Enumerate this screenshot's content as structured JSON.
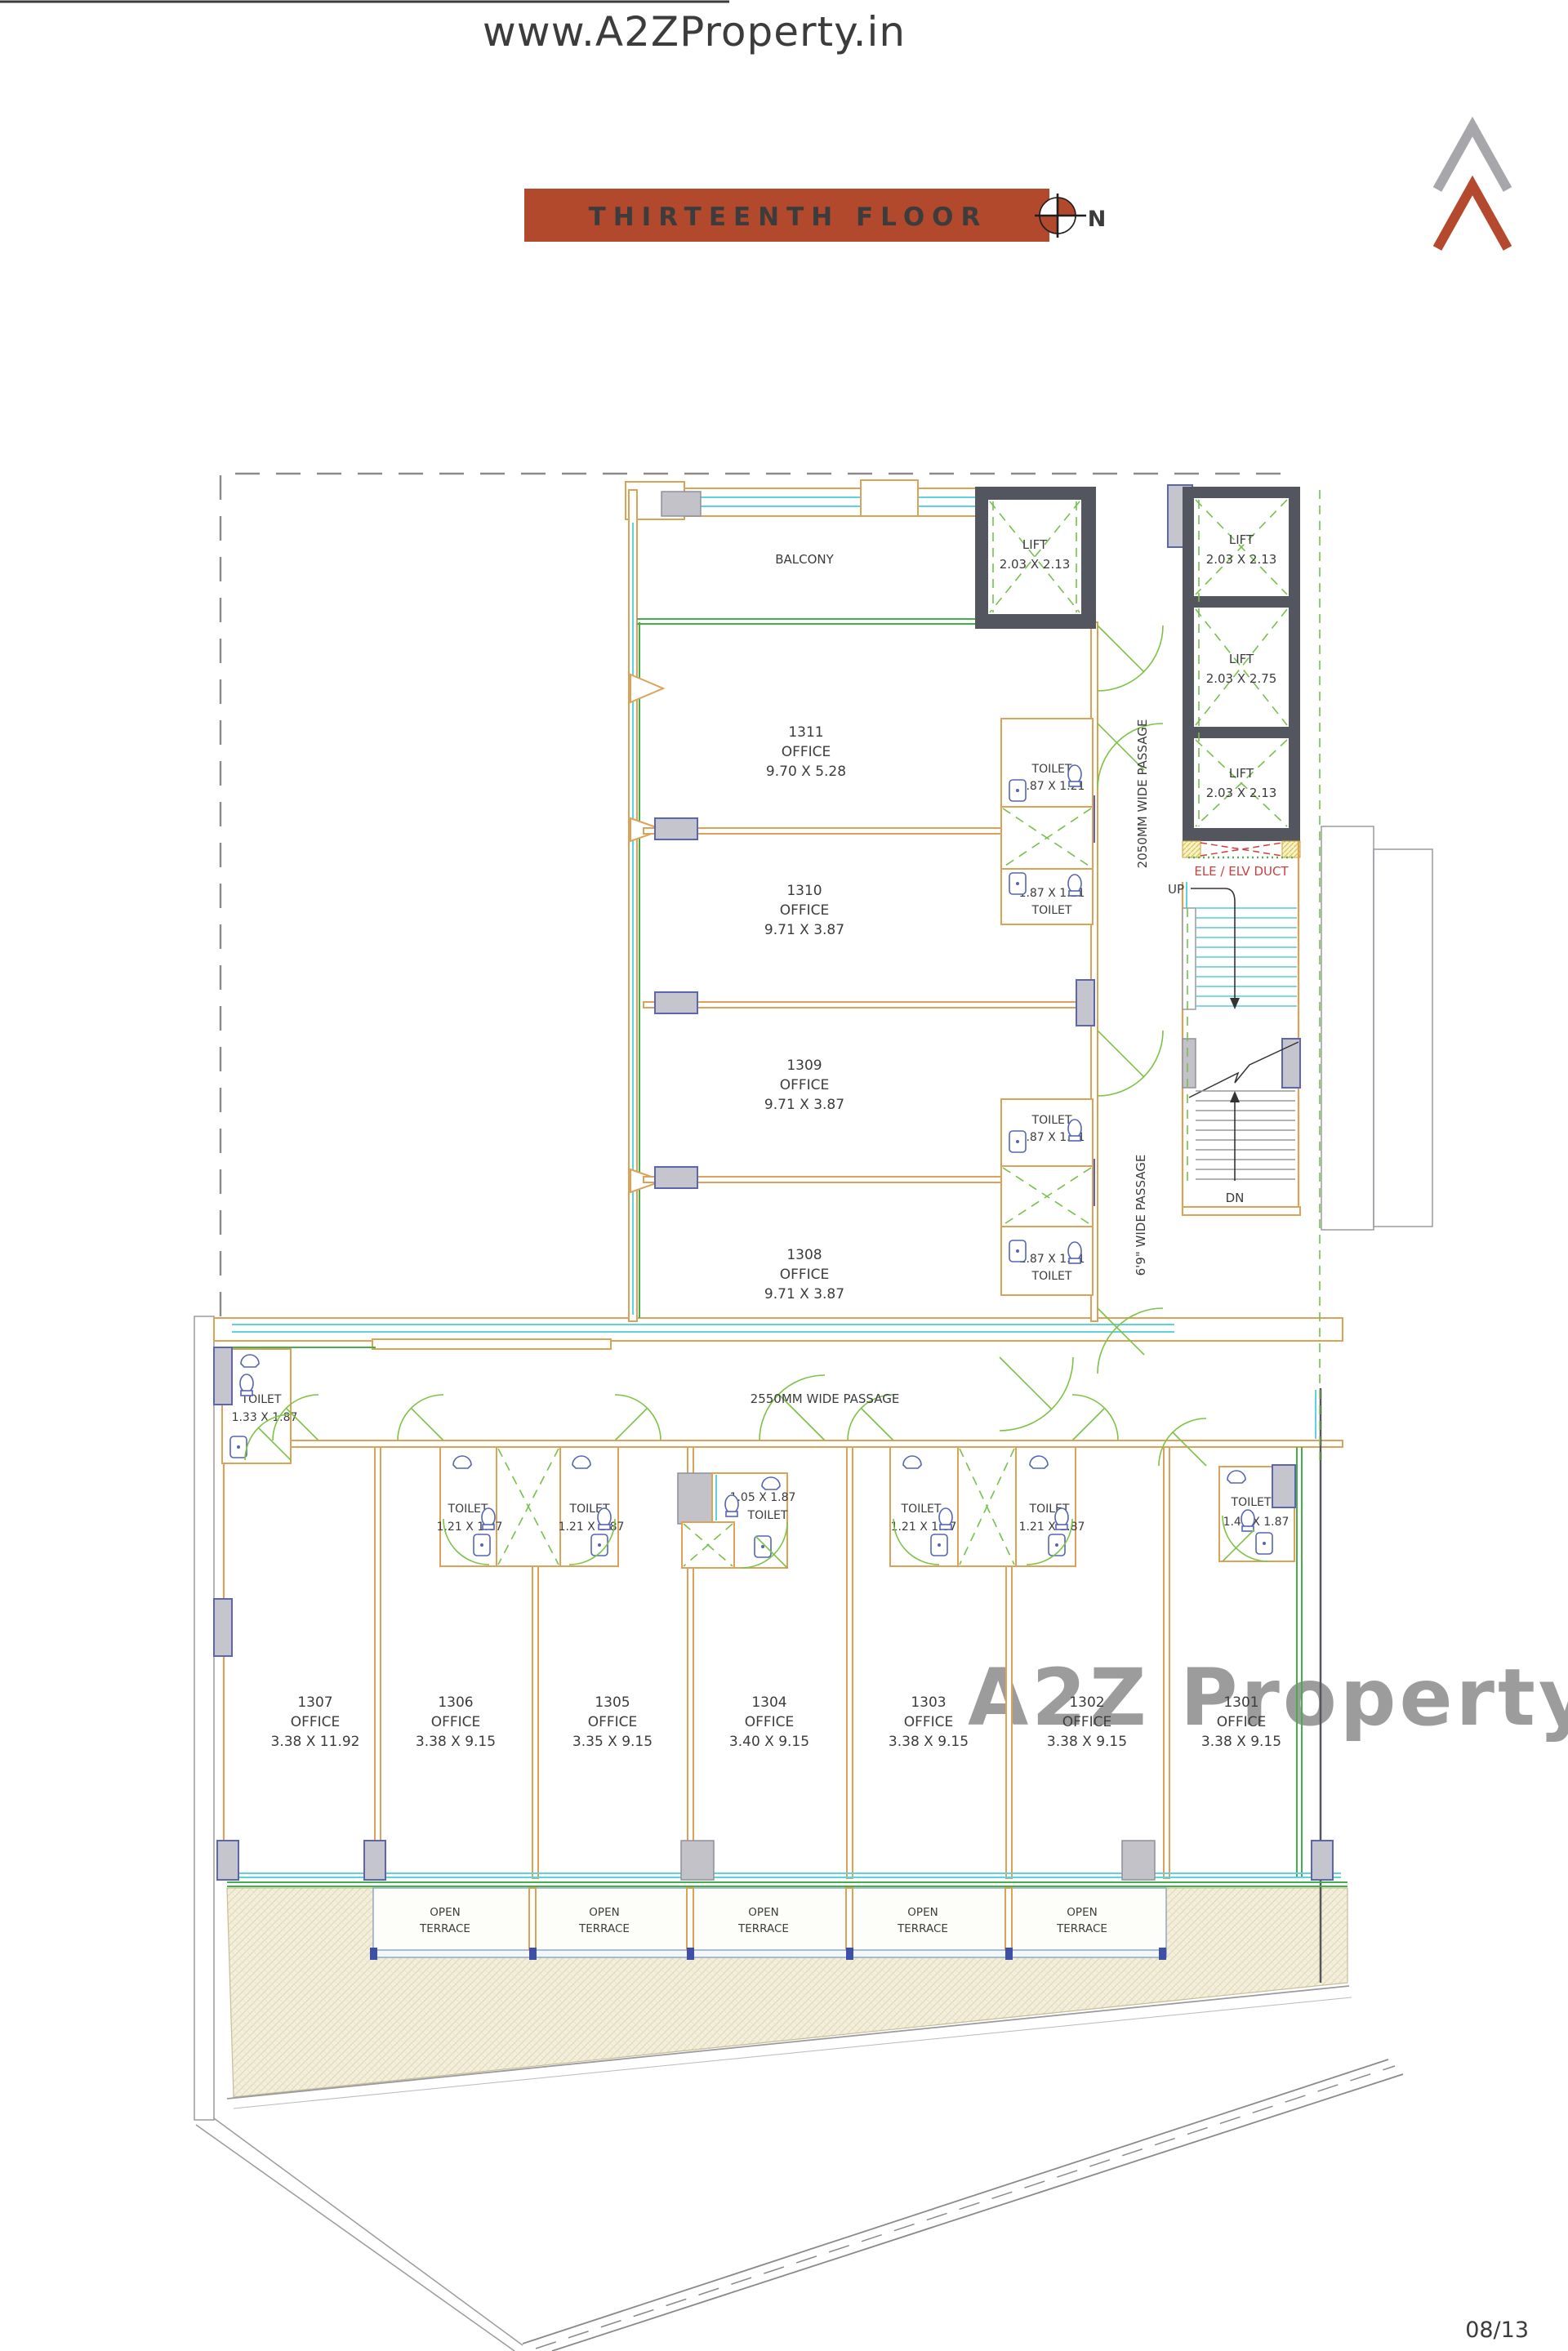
{
  "page": {
    "top_watermark": "www.A2ZProperty.in",
    "center_watermark": "A2Z Property",
    "page_number": "08/13"
  },
  "header": {
    "title": "THIRTEENTH FLOOR",
    "north_label": "N"
  },
  "colors": {
    "title_bar": "#b3492c",
    "logo_gray": "#a7a7ab",
    "logo_red": "#b5492e",
    "wall": "#dca257",
    "glazing": "#5ed3de",
    "green_line": "#43b04c",
    "door_arc": "#7cc345",
    "lift_shaft": "#54565f",
    "column_fill": "#c5c5cd",
    "column_stroke": "#5d64b2",
    "duct_red": "#c94040",
    "hatch_ground": "#f4efdc",
    "watermark_letters": [
      "#e89aa8",
      "#a8c2ec",
      "#f0c08c",
      "#a8d8b4",
      "#f0d28c"
    ]
  },
  "plan": {
    "balcony": "BALCONY",
    "upper_offices": [
      {
        "id": "1311",
        "type": "OFFICE",
        "dim": "9.70 X 5.28"
      },
      {
        "id": "1310",
        "type": "OFFICE",
        "dim": "9.71 X 3.87"
      },
      {
        "id": "1309",
        "type": "OFFICE",
        "dim": "9.71 X 3.87"
      },
      {
        "id": "1308",
        "type": "OFFICE",
        "dim": "9.71 X 3.87"
      }
    ],
    "lower_offices": [
      {
        "id": "1307",
        "type": "OFFICE",
        "dim": "3.38 X 11.92"
      },
      {
        "id": "1306",
        "type": "OFFICE",
        "dim": "3.38 X 9.15"
      },
      {
        "id": "1305",
        "type": "OFFICE",
        "dim": "3.35 X 9.15"
      },
      {
        "id": "1304",
        "type": "OFFICE",
        "dim": "3.40 X 9.15"
      },
      {
        "id": "1303",
        "type": "OFFICE",
        "dim": "3.38 X 9.15"
      },
      {
        "id": "1302",
        "type": "OFFICE",
        "dim": "3.38 X 9.15"
      },
      {
        "id": "1301",
        "type": "OFFICE",
        "dim": "3.38 X 9.15"
      }
    ],
    "lifts": {
      "north": {
        "label": "LIFT",
        "dim": "2.03 X 2.13"
      },
      "stack": [
        {
          "label": "LIFT",
          "dim": "2.03 X 2.13"
        },
        {
          "label": "LIFT",
          "dim": "2.03 X 2.75"
        },
        {
          "label": "LIFT",
          "dim": "2.03 X 2.13"
        }
      ]
    },
    "toilets": {
      "upper": [
        {
          "l1": "TOILET",
          "l2": "1.87 X 1.21"
        },
        {
          "l1": "1.87 X 1.21",
          "l2": "TOILET"
        },
        {
          "l1": "TOILET",
          "l2": "1.87 X 1.21"
        },
        {
          "l1": "1.87 X 1.21",
          "l2": "TOILET"
        }
      ],
      "left": {
        "l1": "TOILET",
        "l2": "1.33 X 1.87"
      },
      "pair1": [
        {
          "l1": "TOILET",
          "l2": "1.21 X 1.87"
        },
        {
          "l1": "TOILET",
          "l2": "1.21 X 1.87"
        }
      ],
      "mid": {
        "l1": "1.05 X 1.87",
        "l2": "TOILET"
      },
      "pair2": [
        {
          "l1": "TOILET",
          "l2": "1.21 X 1.87"
        },
        {
          "l1": "TOILET",
          "l2": "1.21 X 1.87"
        }
      ],
      "right": {
        "l1": "TOILET",
        "l2": "1.48 X 1.87"
      }
    },
    "passages": {
      "p2050": "2050MM WIDE PASSAGE",
      "p69": "6'9\" WIDE PASSAGE",
      "p2550": "2550MM WIDE PASSAGE"
    },
    "duct": "ELE / ELV DUCT",
    "stairs": {
      "up": "UP",
      "dn": "DN"
    },
    "terrace": {
      "line1": "OPEN",
      "line2": "TERRACE",
      "count": 5
    }
  }
}
